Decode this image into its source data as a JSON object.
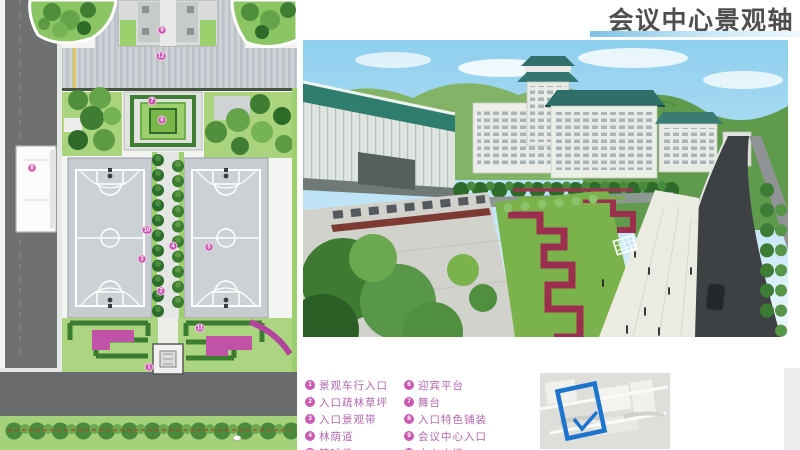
{
  "header": {
    "title": "会议中心景观轴"
  },
  "legend": {
    "items": [
      {
        "num": "1",
        "label": "景观车行入口"
      },
      {
        "num": "2",
        "label": "入口疏林草坪"
      },
      {
        "num": "3",
        "label": "入口景观带"
      },
      {
        "num": "4",
        "label": "林荫道"
      },
      {
        "num": "5",
        "label": "篮球场"
      },
      {
        "num": "6",
        "label": "迎宾平台"
      },
      {
        "num": "7",
        "label": "舞台"
      },
      {
        "num": "8",
        "label": "入口特色铺装"
      },
      {
        "num": "9",
        "label": "会议中心入口"
      },
      {
        "num": "10",
        "label": "中心广场"
      }
    ]
  },
  "plan": {
    "markers": [
      {
        "n": "9",
        "x": 162,
        "y": 30
      },
      {
        "n": "12",
        "x": 161,
        "y": 56
      },
      {
        "n": "7",
        "x": 152,
        "y": 101
      },
      {
        "n": "6",
        "x": 162,
        "y": 120
      },
      {
        "n": "8",
        "x": 32,
        "y": 168
      },
      {
        "n": "10",
        "x": 147,
        "y": 230
      },
      {
        "n": "4",
        "x": 173,
        "y": 246
      },
      {
        "n": "5",
        "x": 209,
        "y": 247
      },
      {
        "n": "3",
        "x": 142,
        "y": 259
      },
      {
        "n": "2",
        "x": 161,
        "y": 291
      },
      {
        "n": "11",
        "x": 200,
        "y": 328
      },
      {
        "n": "1",
        "x": 149,
        "y": 367
      }
    ]
  },
  "colors": {
    "title_text": "#4f4f4f",
    "accent_bar_blue": "#7fc2e6",
    "legend_pink": "#c85bb0",
    "plan_marker_pink": "#c94fad",
    "keyplan_outline_blue": "#1d74cf"
  }
}
